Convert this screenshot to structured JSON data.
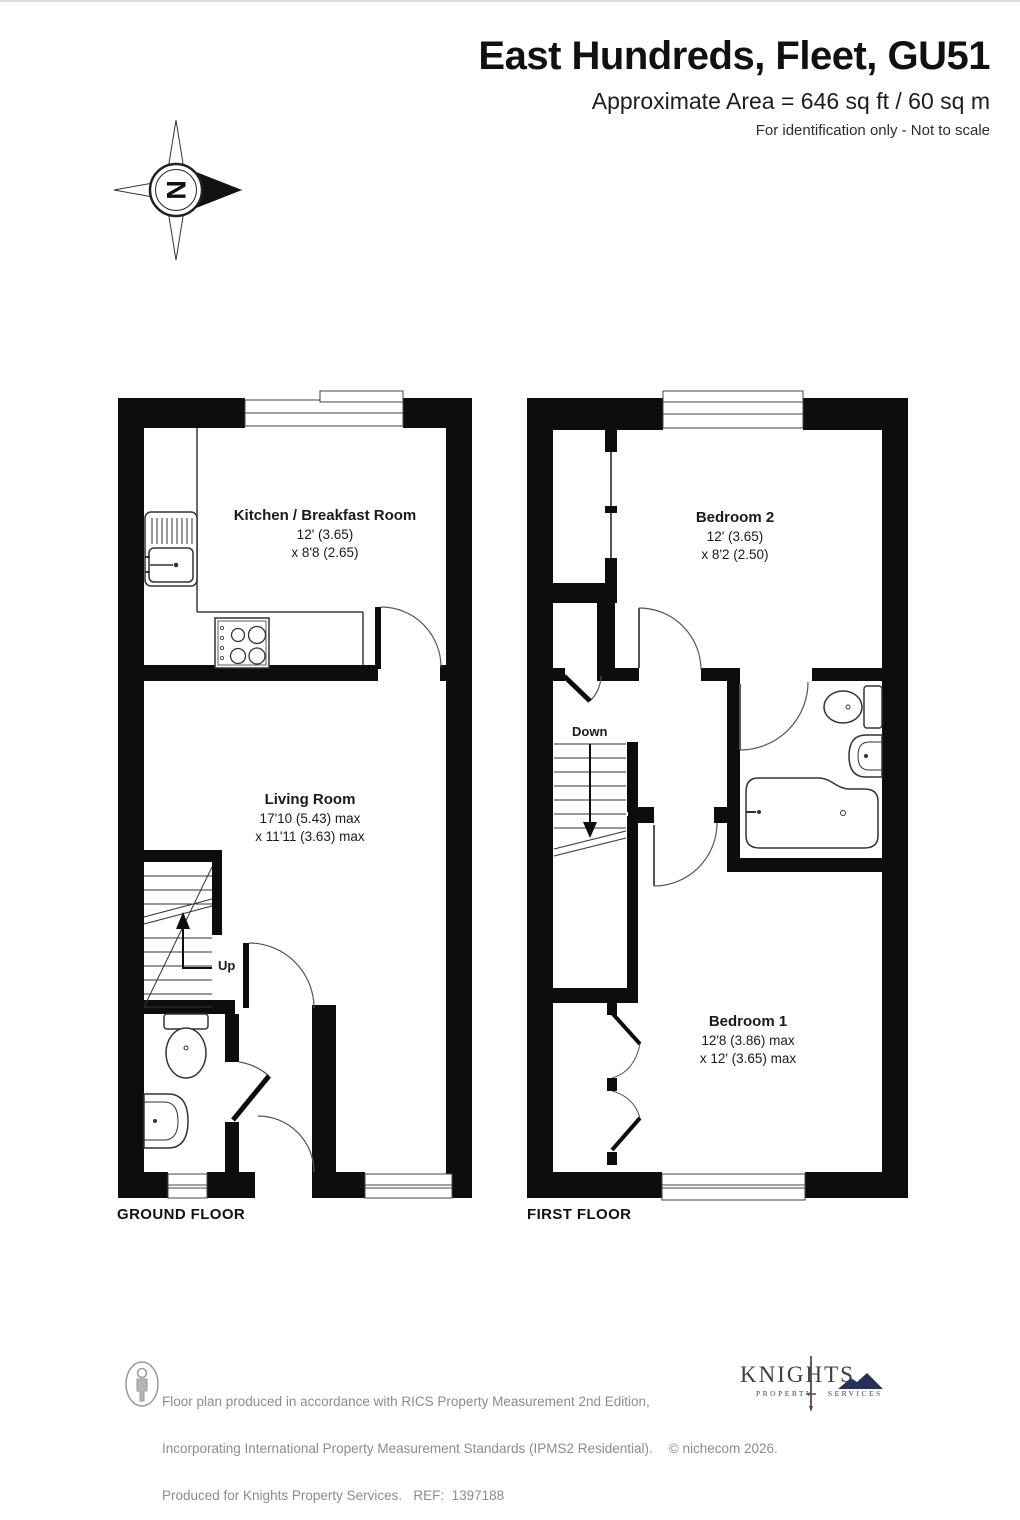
{
  "header": {
    "title": "East Hundreds, Fleet, GU51",
    "area_line": "Approximate Area = 646 sq ft / 60 sq m",
    "disclaimer": "For identification only - Not to scale"
  },
  "compass": {
    "north_label": "N"
  },
  "floors": [
    {
      "label": "GROUND FLOOR",
      "stair_label": "Up",
      "rooms": [
        {
          "name": "Kitchen / Breakfast Room",
          "dim1": "12' (3.65)",
          "dim2": "x 8'8 (2.65)"
        },
        {
          "name": "Living Room",
          "dim1": "17'10 (5.43) max",
          "dim2": "x 11'11 (3.63) max"
        }
      ]
    },
    {
      "label": "FIRST FLOOR",
      "stair_label": "Down",
      "rooms": [
        {
          "name": "Bedroom 2",
          "dim1": "12' (3.65)",
          "dim2": "x 8'2 (2.50)"
        },
        {
          "name": "Bedroom 1",
          "dim1": "12'8 (3.86) max",
          "dim2": "x 12' (3.65) max"
        }
      ]
    }
  ],
  "footer": {
    "line1": "Floor plan produced in accordance with RICS Property Measurement 2nd Edition,",
    "line2": "Incorporating International Property Measurement Standards (IPMS2 Residential).",
    "copyright": "© nichecom 2026.",
    "line3": "Produced for Knights Property Services.   REF:  1397188",
    "logo": {
      "name": "KNIGHTS",
      "sub_left": "PROPERTY",
      "sub_right": "SERVICES"
    }
  },
  "colors": {
    "wall": "#0d0d0d",
    "text": "#1a1a1a",
    "footer_text": "#8c8c8c",
    "logo_text": "#3e3e4d",
    "logo_navy": "#26305a"
  }
}
